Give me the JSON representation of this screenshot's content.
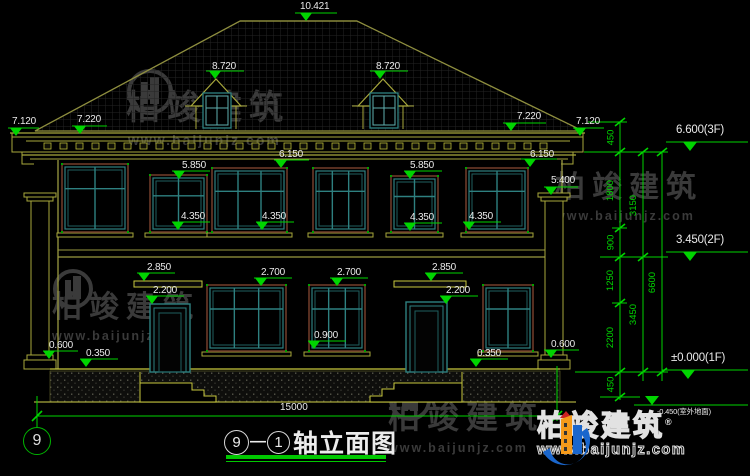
{
  "colors": {
    "dim_green": "#00d400",
    "line_olive": "#a8a83c",
    "line_yellow": "#c8c83e",
    "frame_brown": "#6b3a28",
    "frame_teal": "#2e8080",
    "text_white": "#eaeaea",
    "watermark_gray": "#3a3a3a",
    "logo_blue": "#1a66cc",
    "logo_orange": "#f59a1a"
  },
  "annotations": [
    {
      "t": "10.421",
      "x": 300,
      "y": 2,
      "lx": 295,
      "lw": 42,
      "ly": 13,
      "tx": 306
    },
    {
      "t": "8.720",
      "x": 212,
      "y": 62,
      "lx": 206,
      "lw": 38,
      "ly": 71,
      "tx": 215
    },
    {
      "t": "8.720",
      "x": 376,
      "y": 62,
      "lx": 370,
      "lw": 38,
      "ly": 71,
      "tx": 380
    },
    {
      "t": "7.120",
      "x": 12,
      "y": 117,
      "lx": 8,
      "lw": 31,
      "ly": 128,
      "tx": 16
    },
    {
      "t": "7.220",
      "x": 77,
      "y": 115,
      "lx": 72,
      "lw": 35,
      "ly": 126,
      "tx": 80
    },
    {
      "t": "7.220",
      "x": 517,
      "y": 112,
      "lx": 503,
      "lw": 43,
      "ly": 123,
      "tx": 511
    },
    {
      "t": "7.120",
      "x": 576,
      "y": 117,
      "lx": 573,
      "lw": 31,
      "ly": 128,
      "tx": 580
    },
    {
      "t": "6.150",
      "x": 279,
      "y": 150,
      "lx": 274,
      "lw": 35,
      "ly": 160,
      "tx": 281
    },
    {
      "t": "6.150",
      "x": 530,
      "y": 150,
      "lx": 521,
      "lw": 36,
      "ly": 159,
      "tx": 530
    },
    {
      "t": "5.850",
      "x": 182,
      "y": 161,
      "lx": 172,
      "lw": 38,
      "ly": 171,
      "tx": 179
    },
    {
      "t": "5.850",
      "x": 410,
      "y": 161,
      "lx": 404,
      "lw": 38,
      "ly": 171,
      "tx": 410
    },
    {
      "t": "5.400",
      "x": 551,
      "y": 176,
      "lx": 544,
      "lw": 34,
      "ly": 187,
      "tx": 551
    },
    {
      "t": "4.350",
      "x": 181,
      "y": 212,
      "lx": 172,
      "lw": 38,
      "ly": 222,
      "tx": 178
    },
    {
      "t": "4.350",
      "x": 262,
      "y": 212,
      "lx": 256,
      "lw": 38,
      "ly": 222,
      "tx": 262
    },
    {
      "t": "4.350",
      "x": 410,
      "y": 213,
      "lx": 404,
      "lw": 38,
      "ly": 223,
      "tx": 410
    },
    {
      "t": "4.350",
      "x": 469,
      "y": 212,
      "lx": 463,
      "lw": 38,
      "ly": 222,
      "tx": 469
    },
    {
      "t": "2.850",
      "x": 147,
      "y": 263,
      "lx": 137,
      "lw": 38,
      "ly": 273,
      "tx": 144
    },
    {
      "t": "2.200",
      "x": 153,
      "y": 286,
      "lx": 146,
      "lw": 38,
      "ly": 296,
      "tx": 152
    },
    {
      "t": "2.700",
      "x": 261,
      "y": 268,
      "lx": 254,
      "lw": 38,
      "ly": 278,
      "tx": 261
    },
    {
      "t": "2.700",
      "x": 337,
      "y": 268,
      "lx": 330,
      "lw": 38,
      "ly": 278,
      "tx": 337
    },
    {
      "t": "2.850",
      "x": 432,
      "y": 263,
      "lx": 425,
      "lw": 38,
      "ly": 273,
      "tx": 431
    },
    {
      "t": "2.200",
      "x": 446,
      "y": 286,
      "lx": 440,
      "lw": 38,
      "ly": 296,
      "tx": 446
    },
    {
      "t": "0.900",
      "x": 314,
      "y": 331,
      "lx": 308,
      "lw": 38,
      "ly": 341,
      "tx": 314
    },
    {
      "t": "0.600",
      "x": 49,
      "y": 341,
      "lx": 43,
      "lw": 35,
      "ly": 351,
      "tx": 49
    },
    {
      "t": "0.350",
      "x": 86,
      "y": 349,
      "lx": 80,
      "lw": 38,
      "ly": 359,
      "tx": 86
    },
    {
      "t": "0.350",
      "x": 477,
      "y": 349,
      "lx": 470,
      "lw": 38,
      "ly": 359,
      "tx": 476
    },
    {
      "t": "0.600",
      "x": 551,
      "y": 340,
      "lx": 544,
      "lw": 35,
      "ly": 350,
      "tx": 551
    }
  ],
  "levels": [
    {
      "t": "6.600(3F)",
      "x": 676,
      "y": 125,
      "lx": 666,
      "lw": 82,
      "ly": 142,
      "tx": 690
    },
    {
      "t": "3.450(2F)",
      "x": 676,
      "y": 235,
      "lx": 666,
      "lw": 82,
      "ly": 252,
      "tx": 690
    },
    {
      "t": "±0.000(1F)",
      "x": 671,
      "y": 353,
      "lx": 662,
      "lw": 86,
      "ly": 370,
      "tx": 688
    },
    {
      "t": "-0.450(室外地面)",
      "x": 657,
      "y": 408,
      "lx": 634,
      "lw": 114,
      "ly": 405,
      "tx": 652,
      "flip": true,
      "small": true
    }
  ],
  "chain": {
    "col1": {
      "x": 620,
      "labels": [
        {
          "t": "450",
          "y": 137
        },
        {
          "t": "1800",
          "y": 190
        },
        {
          "t": "900",
          "y": 242
        },
        {
          "t": "1250",
          "y": 280
        },
        {
          "t": "2200",
          "y": 337
        },
        {
          "t": "450",
          "y": 384
        }
      ]
    },
    "col2": {
      "x": 643,
      "labels": [
        {
          "t": "3150",
          "y": 205
        },
        {
          "t": "3450",
          "y": 314
        }
      ]
    },
    "col3": {
      "x": 662,
      "labels": [
        {
          "t": "6600",
          "y": 282
        }
      ]
    }
  },
  "bottom": {
    "overall_dim": "15000",
    "axis_bubble": "9",
    "title_bubble_left": "9",
    "title_bubble_right": "1",
    "title_text": "轴立面图"
  },
  "watermark": {
    "brand": "柏竣建筑",
    "url": "www.baijunjz.com"
  },
  "logo": {
    "brand": "柏竣建筑",
    "reg": "®",
    "url": "www.baijunjz.com"
  }
}
